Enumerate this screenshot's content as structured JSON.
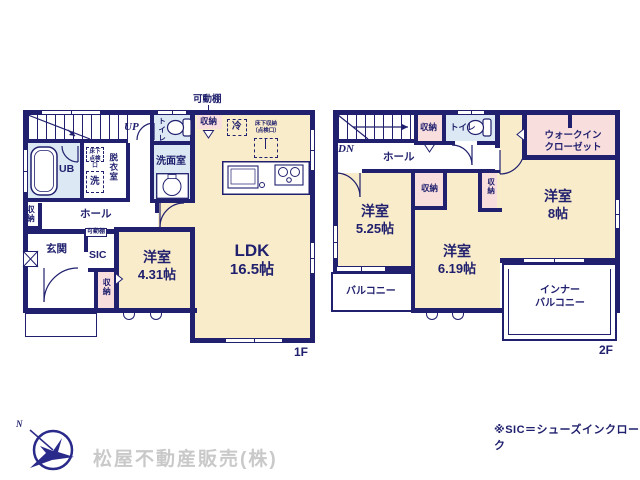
{
  "colors": {
    "wall": "#20206e",
    "room_fill": "#f9ecca",
    "wet_fill": "#dce9f4",
    "closet_fill": "#f9dede",
    "company_text": "#c9c9c9"
  },
  "floor1": {
    "label": "1F",
    "shelf_top": "可動棚",
    "up": "UP",
    "ldk_name": "LDK",
    "ldk_size": "16.5帖",
    "bed_name": "洋室",
    "bed_size": "4.31帖",
    "genkan": "玄関",
    "sic": "SIC",
    "shelf_sic": "可動棚",
    "hall": "ホール",
    "ub": "UB",
    "datsui": "脱衣室",
    "senmen": "洗面室",
    "toilet": "トイレ",
    "sto_top": "収納",
    "sto_hall": "収納",
    "sto_genkan": "収納",
    "fridge": "冷",
    "floor_sto_l1": "床下収納",
    "floor_sto_l2": "（点検口）",
    "floor_insp_l1": "床下",
    "floor_insp_l2": "点検口",
    "wash": "洗"
  },
  "floor2": {
    "label": "2F",
    "dn": "DN",
    "hall": "ホール",
    "toilet": "トイレ",
    "sto_hall": "収納",
    "sto_a": "収納",
    "sto_b": "収納",
    "wic_l1": "ウォークイン",
    "wic_l2": "クローゼット",
    "bed1_name": "洋室",
    "bed1_size": "5.25帖",
    "bed2_name": "洋室",
    "bed2_size": "6.19帖",
    "bed3_name": "洋室",
    "bed3_size": "8帖",
    "balcony": "バルコニー",
    "inner_l1": "インナー",
    "inner_l2": "バルコニー"
  },
  "footer": {
    "company": "松屋不動産販売(株)",
    "note": "※SIC＝シューズインクローク",
    "north": "N"
  }
}
